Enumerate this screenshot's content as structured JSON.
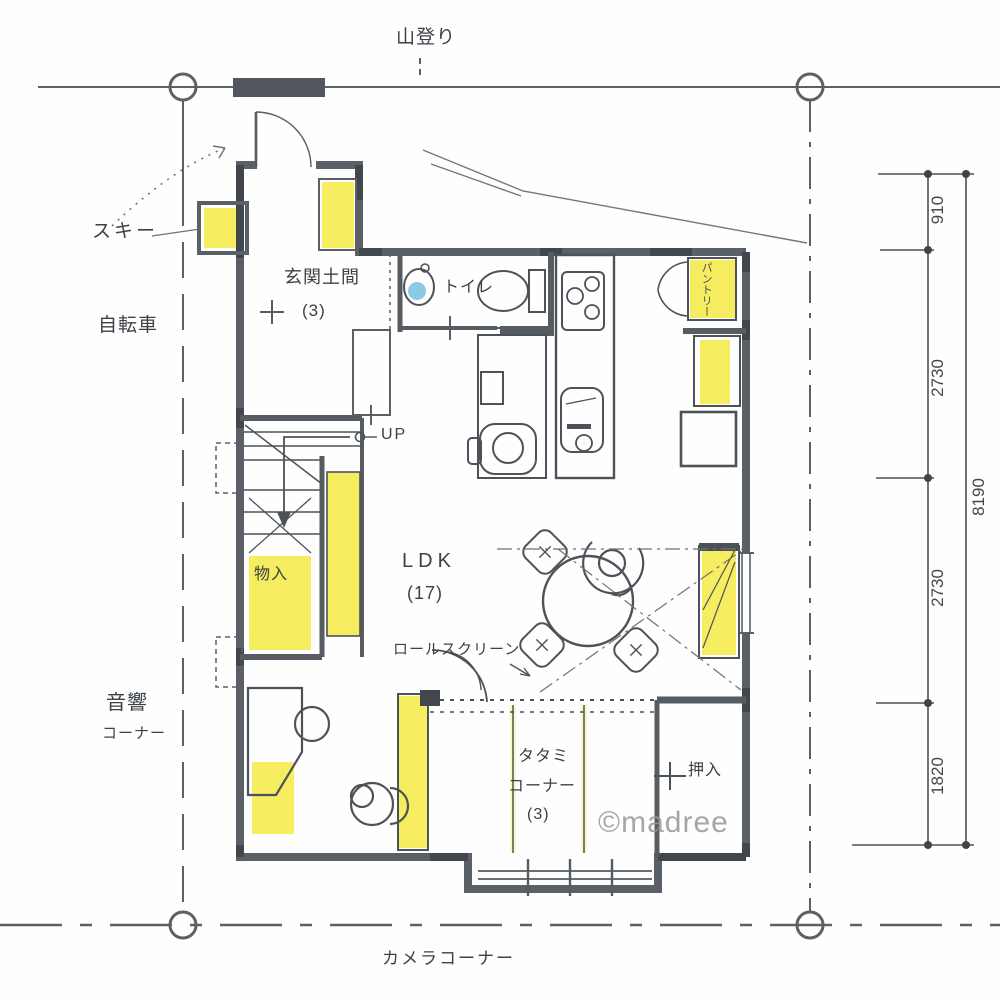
{
  "site": {
    "approach_label": "山登り",
    "camera_corner": "カメラコーナー"
  },
  "exterior_storage": {
    "ski": "スキー",
    "bicycle": "自転車"
  },
  "rooms": {
    "entrance": {
      "name": "玄関土間",
      "size": "(3)"
    },
    "toilet": "トイレ",
    "pantry": "パントリー",
    "stairs": {
      "up": "UP"
    },
    "closet": "物入",
    "ldk": {
      "name": "LDK",
      "size": "(17)"
    },
    "tatami": {
      "line1": "タタミ",
      "line2": "コーナー",
      "size": "(3)"
    },
    "oshiire": "押入",
    "audio": {
      "line1": "音響",
      "line2": "コーナー"
    }
  },
  "fixtures": {
    "roll_screen": "ロールスクリーン"
  },
  "dimensions": {
    "chain": [
      "910",
      "2730",
      "2730",
      "1820"
    ],
    "overall": "8190"
  },
  "watermark": "©madree",
  "colors": {
    "highlight_yellow": "#f4e838",
    "pencil_ink": "#4a5055",
    "wall_gray": "#5a6065",
    "water_blue": "#8ec9e4"
  }
}
